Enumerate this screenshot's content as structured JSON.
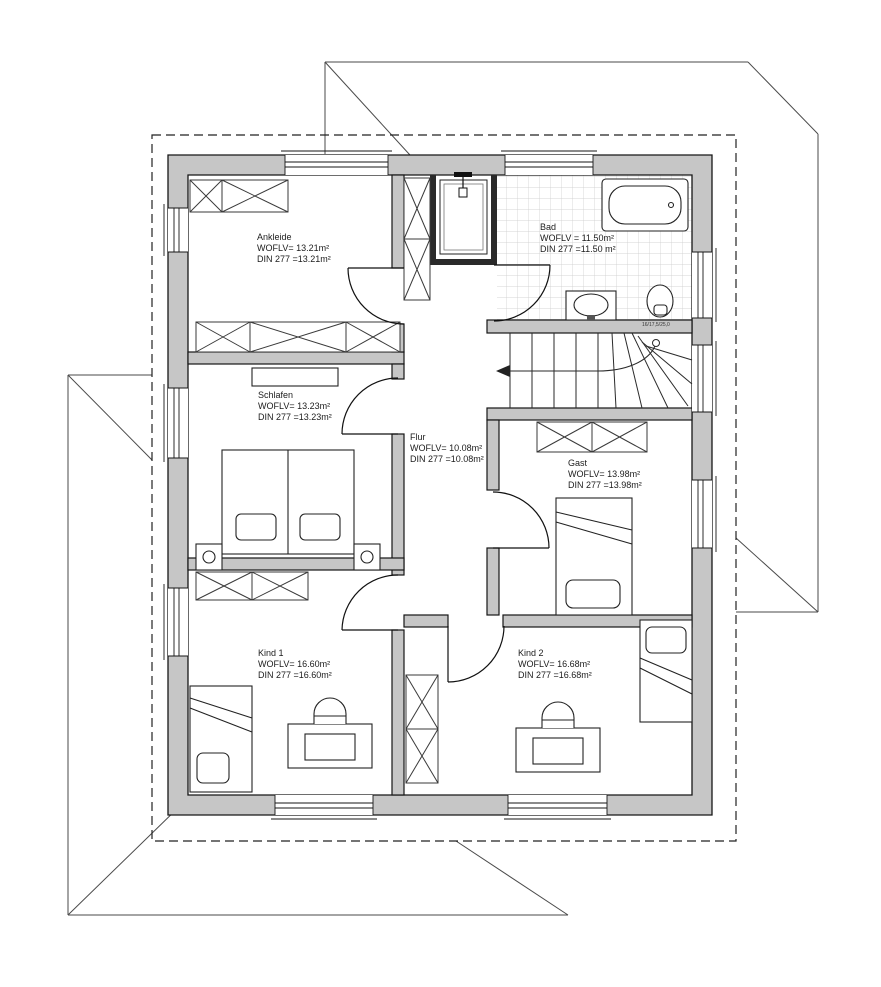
{
  "drawing": {
    "kind": "architectural floor plan (upper storey, German labels)",
    "colors": {
      "wall_fill": "#c6c6c6",
      "line": "#1a1a1a",
      "tile_line": "#c9c9c9",
      "roof_line": "#4a4a4a"
    }
  },
  "rooms": [
    {
      "id": "ankleide",
      "name": "Ankleide",
      "woflv": "WOFLV= 13.21m²",
      "din": "DIN 277 =13.21m²"
    },
    {
      "id": "bad",
      "name": "Bad",
      "woflv": "WOFLV = 11.50m²",
      "din": "DIN 277 =11.50 m²"
    },
    {
      "id": "schlafen",
      "name": "Schlafen",
      "woflv": "WOFLV= 13.23m²",
      "din": "DIN 277 =13.23m²"
    },
    {
      "id": "flur",
      "name": "Flur",
      "woflv": "WOFLV= 10.08m²",
      "din": "DIN 277 =10.08m²"
    },
    {
      "id": "gast",
      "name": "Gast",
      "woflv": "WOFLV= 13.98m²",
      "din": "DIN 277 =13.98m²"
    },
    {
      "id": "kind1",
      "name": "Kind 1",
      "woflv": "WOFLV= 16.60m²",
      "din": "DIN 277 =16.60m²"
    },
    {
      "id": "kind2",
      "name": "Kind 2",
      "woflv": "WOFLV= 16.68m²",
      "din": "DIN 277 =16.68m²"
    }
  ],
  "stairs": {
    "note": "16/17,5/25,0"
  }
}
